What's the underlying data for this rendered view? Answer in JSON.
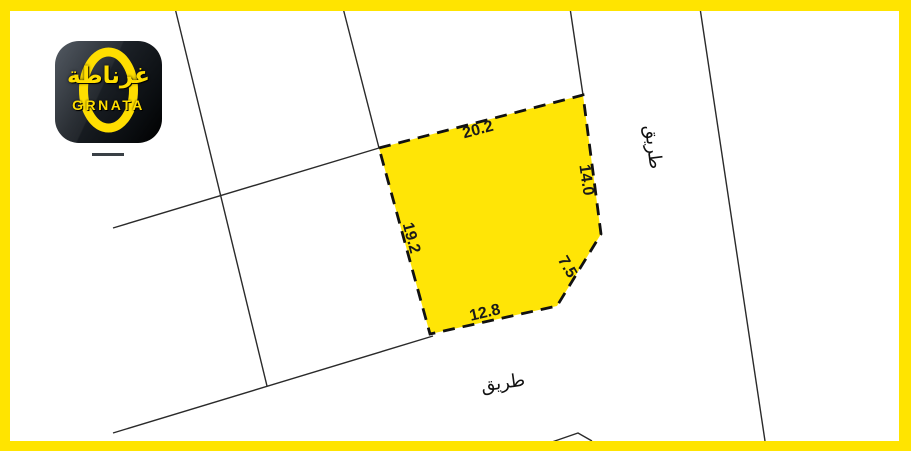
{
  "branding": {
    "logo_arabic": "غرناطة",
    "logo_latin": "GRNATA"
  },
  "plot": {
    "dim_top": "20.2",
    "dim_right": "14.0",
    "dim_left": "19.2",
    "dim_corner": "7.5",
    "dim_bottom": "12.8"
  },
  "roads": {
    "right_road_label": "طريق",
    "bottom_road_label": "طريق"
  },
  "colors": {
    "frame_yellow": "#ffe400",
    "plot_fill": "#ffe506",
    "plot_outline": "#111111",
    "parcel_line": "#2a2a2a",
    "logo_yellow": "#ffde00"
  }
}
